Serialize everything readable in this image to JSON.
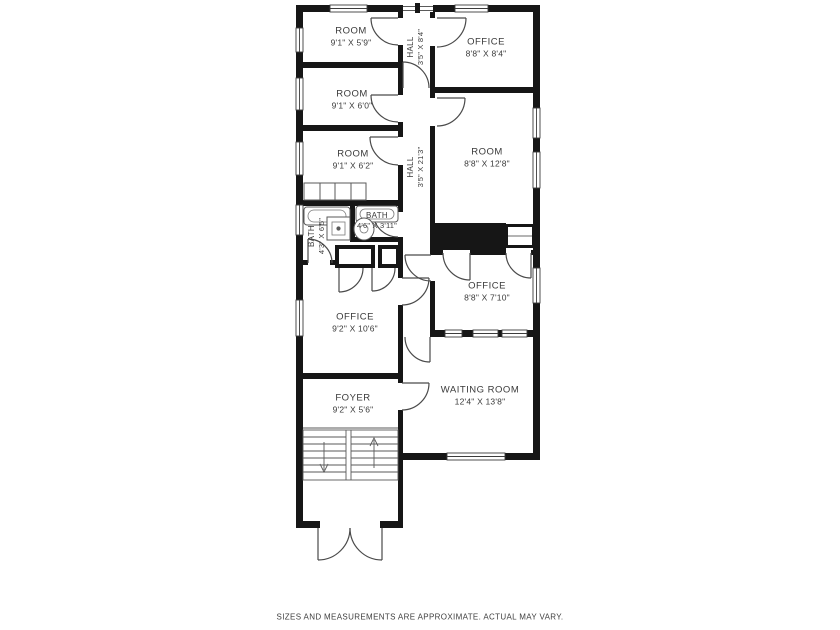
{
  "rooms": {
    "room1": {
      "name": "ROOM",
      "dims": "9'1\" X 5'9\""
    },
    "room2": {
      "name": "ROOM",
      "dims": "9'1\" X 6'0\""
    },
    "room3": {
      "name": "ROOM",
      "dims": "9'1\" X 6'2\""
    },
    "hall_top": {
      "name": "HALL",
      "dims": "3'5\" X 8'4\""
    },
    "office_top": {
      "name": "OFFICE",
      "dims": "8'8\" X 8'4\""
    },
    "hall_main": {
      "name": "HALL",
      "dims": "3'5\" X 21'3\""
    },
    "room_right": {
      "name": "ROOM",
      "dims": "8'8\" X 12'8\""
    },
    "bath_left": {
      "name": "BATH",
      "dims": "4'3\" X 6'5\""
    },
    "bath_right": {
      "name": "BATH",
      "dims": "4'6\" X 3'11\""
    },
    "office_mid": {
      "name": "OFFICE",
      "dims": "8'8\" X 7'10\""
    },
    "office_left": {
      "name": "OFFICE",
      "dims": "9'2\" X 10'6\""
    },
    "foyer": {
      "name": "FOYER",
      "dims": "9'2\" X 5'6\""
    },
    "waiting_room": {
      "name": "WAITING ROOM",
      "dims": "12'4\" X 13'8\""
    }
  },
  "footer": {
    "disclaimer": "SIZES AND MEASUREMENTS ARE APPROXIMATE. ACTUAL MAY VARY."
  },
  "colors": {
    "wall": "#161616",
    "door_line": "#4a4a4a",
    "label_text": "#3a3a3a",
    "background": "#ffffff"
  }
}
